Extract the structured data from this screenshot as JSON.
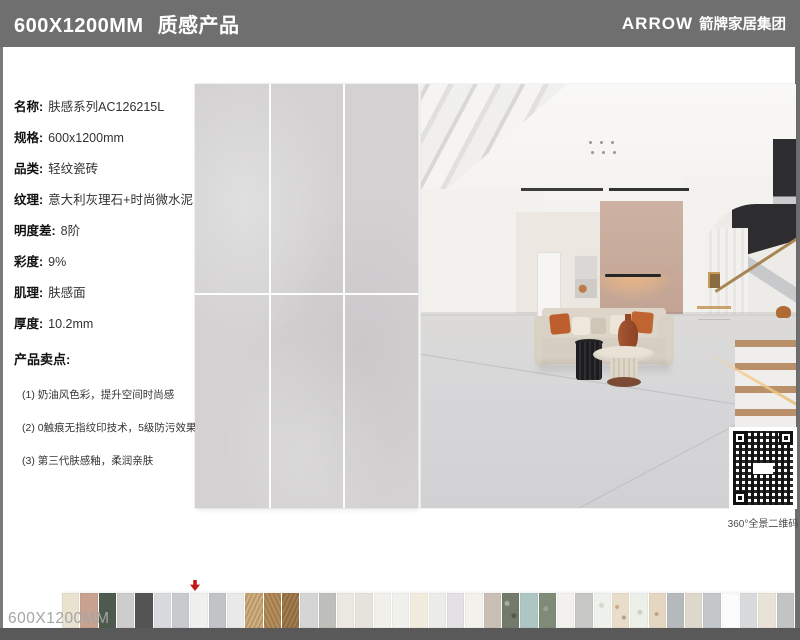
{
  "header": {
    "size": "600X1200MM",
    "series": "质感产品",
    "brand_en": "ARROW",
    "brand_cn": "箭牌家居集团"
  },
  "specs": {
    "rows": [
      {
        "label": "名称:",
        "value": "肤感系列AC126215L"
      },
      {
        "label": "规格:",
        "value": "600x1200mm"
      },
      {
        "label": "品类:",
        "value": "轻纹瓷砖"
      },
      {
        "label": "纹理:",
        "value": "意大利灰理石+时尚微水泥"
      },
      {
        "label": "明度差:",
        "value": "8阶"
      },
      {
        "label": "彩度:",
        "value": "9%"
      },
      {
        "label": "肌理:",
        "value": "肤感面"
      },
      {
        "label": "厚度:",
        "value": "10.2mm"
      }
    ]
  },
  "selling_points": {
    "title": "产品卖点:",
    "items": [
      "(1) 奶油风色彩，提升空间时尚感",
      "(2) 0触痕无指纹印技术，5级防污效果",
      "(3) 第三代肤感釉，柔润亲肤"
    ]
  },
  "qr": {
    "caption": "360°全景二维码"
  },
  "footer": {
    "size_label": "600X1200MM"
  },
  "colors": {
    "header_bg": "#706f6f",
    "footer_bar": "#595959",
    "tile": "#d3d1d2",
    "accent_wall": "linear-gradient(180deg,#cdb2a3,#c2a494)",
    "arrow": "#bf1816"
  },
  "swatches": {
    "highlight_index": 5,
    "items": [
      {
        "bg": "#e9e2cf"
      },
      {
        "bg": "#c8a191"
      },
      {
        "bg": "#4d5a4d"
      },
      {
        "bg": "#cccdcc"
      },
      {
        "bg": "#545454"
      },
      {
        "bg": "#d8dade"
      },
      {
        "bg": "#c8cacd"
      },
      {
        "bg": "#f0f0ee"
      },
      {
        "bg": "#c2c3c7"
      },
      {
        "bg": "#e9e9e7"
      },
      {
        "bg": "repeating-linear-gradient(115deg,#cfb183 0 2px,#b99768 2px 4px)"
      },
      {
        "bg": "repeating-linear-gradient(65deg,#b68f5e 0 2px,#a17c4a 2px 4px)"
      },
      {
        "bg": "repeating-linear-gradient(115deg,#a37e50 0 2px,#8d6a40 2px 4px)"
      },
      {
        "bg": "#d4d5d4"
      },
      {
        "bg": "#bebebb"
      },
      {
        "bg": "#ebe8e1"
      },
      {
        "bg": "#e5e3db"
      },
      {
        "bg": "#f2f0ea"
      },
      {
        "bg": "#f0f1ed"
      },
      {
        "bg": "#f1ecdd"
      },
      {
        "bg": "#ecece8"
      },
      {
        "bg": "#e3e1e4"
      },
      {
        "bg": "#f3f1eb"
      },
      {
        "bg": "#cabfb5"
      },
      {
        "bg": "radial-gradient(circle at 30% 30%,#a9ae9b 0 2px,transparent 3px),radial-gradient(circle at 70% 65%,#545a4d 0 2px,transparent 3px),#747a6b"
      },
      {
        "bg": "#aec6c3"
      },
      {
        "bg": "radial-gradient(circle at 40% 45%,#9aa38f 0 2px,transparent 3px),#808b77"
      },
      {
        "bg": "#f3f1ee"
      },
      {
        "bg": "#c7c8c5"
      },
      {
        "bg": "radial-gradient(circle at 45% 35%,#d3d8cc 0 2px,transparent 3px),#eff1ec"
      },
      {
        "bg": "radial-gradient(circle at 30% 40%,#c9a98a 0 1.5px,transparent 2.5px),radial-gradient(circle at 70% 70%,#b0a088 0 1.5px,transparent 2.5px),#e8ddc9"
      },
      {
        "bg": "radial-gradient(circle at 55% 55%,#ccd2c4 0 2px,transparent 3px),#edefe9"
      },
      {
        "bg": "radial-gradient(circle at 45% 60%,#bfa184 0 1.5px,transparent 2.5px),#e4d6c1"
      },
      {
        "bg": "#b6b9bc"
      },
      {
        "bg": "#ded7cc"
      },
      {
        "bg": "#c4c7ca"
      },
      {
        "bg": "#fcfcfc"
      },
      {
        "bg": "#d9dadc"
      },
      {
        "bg": "#e9e3d7"
      },
      {
        "bg": "#c1c3c5"
      }
    ]
  }
}
